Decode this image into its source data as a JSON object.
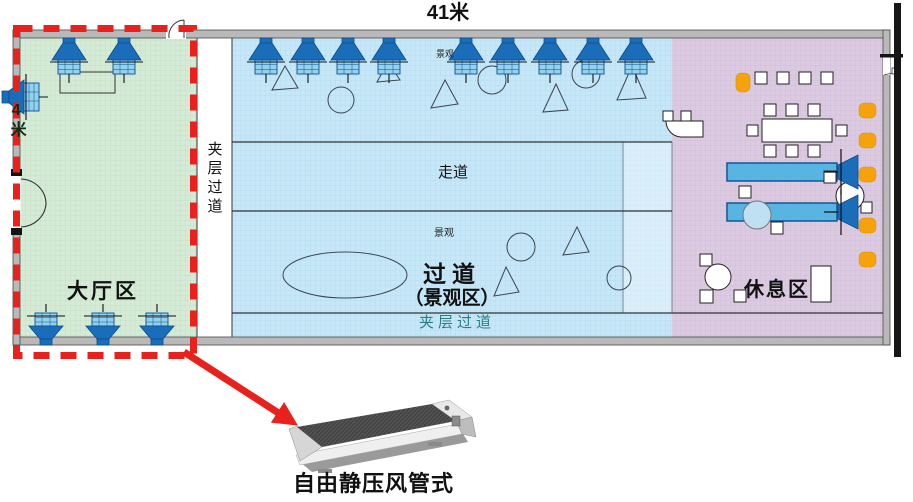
{
  "dimensions": {
    "width_label": "41米",
    "height_label": "4米"
  },
  "areas": {
    "lobby": "大厅区",
    "corridor_main": "过道",
    "corridor_sub": "（景观区）",
    "rest": "休息区",
    "walkway": "走道",
    "mezzanine_side": "夹层过道",
    "mezzanine_bottom": "夹层过道",
    "landscape_top": "景观",
    "landscape_mid": "景观"
  },
  "caption": "自由静压风管式",
  "colors": {
    "zone_green": "#d5ebd6",
    "zone_green_grid": "#b7d8bc",
    "zone_blue": "#c6e7f7",
    "zone_blue_grid": "#a6d4ea",
    "zone_purple": "#dccae1",
    "zone_purple_grid": "#c9b2d3",
    "fan_dark_blue": "#1a6db8",
    "fan_outline": "#0b4d8f",
    "fan_box_blue": "#93d2ef",
    "bar_blue": "#58b5e1",
    "seat_orange": "#f5a30a",
    "highlight_red": "#e8211c",
    "wall_gray": "#b9b9b9",
    "line": "#2b2b2b",
    "mezzanine_text_teal": "#2b7d85"
  },
  "plan": {
    "fans_down": [
      [
        69,
        38
      ],
      [
        124,
        38
      ],
      [
        266,
        38
      ],
      [
        308,
        38
      ],
      [
        348,
        38
      ],
      [
        389,
        38
      ],
      [
        466,
        38
      ],
      [
        508,
        38
      ],
      [
        550,
        38
      ],
      [
        593,
        38
      ],
      [
        636,
        38
      ]
    ],
    "fans_up": [
      46,
      103,
      157
    ],
    "fan_left": [
      [
        2,
        97
      ]
    ],
    "nozzles_right": [
      [
        838,
        172
      ],
      [
        838,
        212
      ]
    ],
    "landscape": {
      "triangles": [
        [
          272,
          90,
          285,
          66,
          298,
          88
        ],
        [
          377,
          82,
          388,
          62,
          400,
          80
        ],
        [
          431,
          108,
          445,
          80,
          458,
          104
        ],
        [
          543,
          112,
          556,
          84,
          568,
          110
        ],
        [
          617,
          100,
          632,
          66,
          646,
          98
        ],
        [
          494,
          296,
          506,
          267,
          519,
          292
        ],
        [
          563,
          255,
          577,
          227,
          589,
          252
        ]
      ],
      "circles": [
        [
          341,
          100,
          13
        ],
        [
          492,
          80,
          14
        ],
        [
          586,
          74,
          14
        ],
        [
          521,
          247,
          14
        ],
        [
          619,
          278,
          12
        ]
      ],
      "ellipses": [
        [
          345,
          275,
          62,
          23
        ]
      ]
    },
    "furniture": {
      "squares": [
        [
          755,
          72,
          12
        ],
        [
          777,
          72,
          12
        ],
        [
          799,
          72,
          12
        ],
        [
          821,
          72,
          12
        ],
        [
          764,
          104,
          12
        ],
        [
          786,
          104,
          12
        ],
        [
          808,
          104,
          12
        ],
        [
          764,
          145,
          12
        ],
        [
          786,
          145,
          12
        ],
        [
          808,
          145,
          12
        ],
        [
          747,
          125,
          11
        ],
        [
          836,
          125,
          11
        ],
        [
          663,
          111,
          10
        ],
        [
          681,
          111,
          10
        ],
        [
          739,
          186,
          12
        ],
        [
          771,
          222,
          12
        ],
        [
          824,
          171,
          12
        ],
        [
          861,
          202,
          11
        ],
        [
          700,
          254,
          12
        ],
        [
          700,
          290,
          13
        ],
        [
          734,
          290,
          12
        ]
      ],
      "tables": [
        [
          762,
          119,
          70,
          23
        ],
        [
          811,
          266,
          20,
          36
        ]
      ],
      "outlines": [
        [
          60,
          72,
          55,
          21
        ]
      ],
      "circles_white": [
        [
          850,
          196,
          14
        ],
        [
          718,
          277,
          13
        ]
      ],
      "circles_blue": [
        [
          757,
          215,
          14
        ]
      ],
      "bars": [
        [
          727,
          163,
          110,
          18
        ],
        [
          727,
          203,
          110,
          18
        ]
      ],
      "orange_seats": [
        [
          736,
          73,
          14,
          19
        ],
        [
          859,
          103,
          17,
          15
        ],
        [
          859,
          133,
          17,
          15
        ],
        [
          859,
          167,
          17,
          15
        ],
        [
          859,
          218,
          17,
          15
        ],
        [
          859,
          252,
          17,
          15
        ]
      ]
    }
  }
}
